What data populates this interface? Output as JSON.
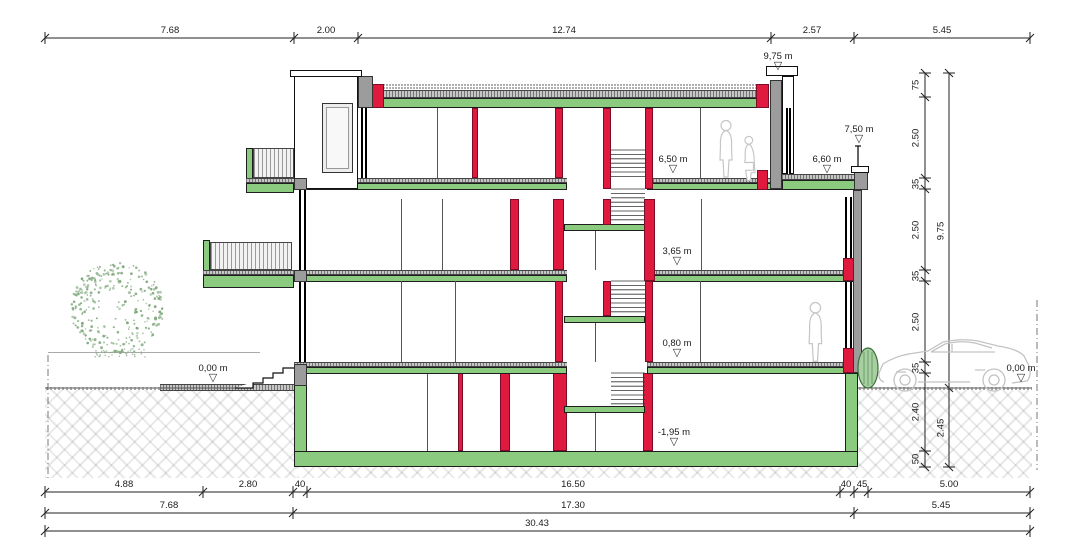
{
  "drawing": {
    "title": "building-cross-section",
    "dim_top": [
      "7.68",
      "2.00",
      "12.74",
      "2.57",
      "5.45"
    ],
    "dim_row1": [
      "4.88",
      "2.80",
      "40",
      "16.50",
      "40",
      "45",
      "5.00"
    ],
    "dim_row2": [
      "7.68",
      "17.30",
      "5.45"
    ],
    "dim_row3": [
      "30.43"
    ],
    "dim_right_inner": [
      "75",
      "2.50",
      "35",
      "2.50",
      "35",
      "2.50",
      "35",
      "2.40",
      "50"
    ],
    "dim_right_outer": [
      "9.75",
      "2.45"
    ],
    "levels": {
      "roof_parapet": "9,75 m",
      "terrace_railing": "7,50 m",
      "top_floor": "6,50 m",
      "roof_terrace": "6,60 m",
      "second_floor": "3,65 m",
      "ground_floor": "0,80 m",
      "street_left": "0,00 m",
      "street_right": "0,00 m",
      "basement": "-1,95 m"
    },
    "marker_glyph": "▽",
    "colors": {
      "structure_red": "#e0193f",
      "slab_green": "#8acb80",
      "concrete_gray": "#9c9c9c",
      "tree_green": "#7fa87c"
    }
  }
}
